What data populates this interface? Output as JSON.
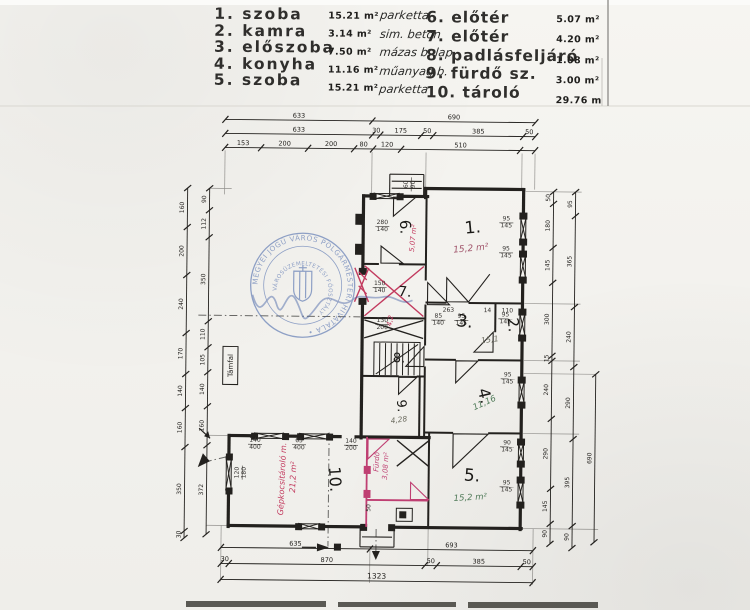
{
  "legend": {
    "left": [
      {
        "no": "1.",
        "name": "szoba",
        "area": "15.21 m²",
        "material": "parketta"
      },
      {
        "no": "2.",
        "name": "kamra",
        "area": "3.14 m²",
        "material": "sim. beton"
      },
      {
        "no": "3.",
        "name": "előszoba",
        "area": "7.50 m²",
        "material": "mázas b. lap"
      },
      {
        "no": "4.",
        "name": "konyha",
        "area": "11.16 m²",
        "material": "műanyag b."
      },
      {
        "no": "5.",
        "name": "szoba",
        "area": "15.21 m²",
        "material": "parketta"
      }
    ],
    "right": [
      {
        "no": "6.",
        "name": "előtér",
        "area": "5.07 m²",
        "material": "má—"
      },
      {
        "no": "7.",
        "name": "előtér",
        "area": "4.20 m²",
        "material": "má—"
      },
      {
        "no": "8.",
        "name": "padlásfeljáró",
        "area": "1.08 m²",
        "material": "fa—"
      },
      {
        "no": "9.",
        "name": "fürdő sz.",
        "area": "3.00 m²",
        "material": "má—"
      },
      {
        "no": "10.",
        "name": "tároló",
        "area": "29.76 m²",
        "material": "si—"
      }
    ]
  },
  "stamp": {
    "ring_text": "MEGYEI JOGÚ VÁROS POLGÁRMESTERI HIVATALA •",
    "inner_text": "VÁROSÜZEMELTETÉSI FŐOSZTÁLY",
    "cx": 302,
    "cy": 286,
    "r1": 52,
    "r2": 35
  },
  "colors": {
    "ink": "#23211e",
    "red": "#c23a5e",
    "magenta": "#bf3f72",
    "green": "#4f7a58",
    "pencil": "#6b6b5f",
    "blue": "#3d5ea6"
  },
  "plan": {
    "walls": [
      [
        362,
        196,
        372,
        196
      ],
      [
        398,
        196,
        426,
        196
      ],
      [
        424,
        188,
        522,
        188
      ],
      [
        424,
        188,
        424,
        197
      ],
      [
        522,
        188,
        522,
        215
      ],
      [
        522,
        240,
        522,
        252
      ],
      [
        522,
        277,
        522,
        310
      ],
      [
        522,
        335,
        522,
        378
      ],
      [
        522,
        403,
        522,
        440
      ],
      [
        522,
        462,
        522,
        478
      ],
      [
        522,
        503,
        522,
        528
      ],
      [
        362,
        196,
        362,
        272
      ],
      [
        362,
        302,
        362,
        438
      ],
      [
        230,
        437,
        255,
        437
      ],
      [
        285,
        437,
        300,
        437
      ],
      [
        330,
        437,
        341,
        437
      ],
      [
        357,
        437,
        430,
        437
      ],
      [
        230,
        437,
        230,
        458
      ],
      [
        230,
        492,
        230,
        528
      ],
      [
        230,
        527,
        300,
        527
      ],
      [
        322,
        527,
        365,
        527
      ],
      [
        392,
        527,
        523,
        527
      ]
    ],
    "inner": [
      [
        362,
        264,
        378,
        264
      ],
      [
        398,
        264,
        425,
        264
      ],
      [
        362,
        318,
        425,
        318
      ],
      [
        425,
        197,
        425,
        280
      ],
      [
        425,
        304,
        425,
        345
      ],
      [
        425,
        366,
        425,
        438
      ],
      [
        425,
        302,
        446,
        302
      ],
      [
        468,
        302,
        522,
        302
      ],
      [
        495,
        302,
        495,
        331
      ],
      [
        425,
        359,
        456,
        359
      ],
      [
        478,
        359,
        522,
        359
      ],
      [
        362,
        376,
        399,
        376
      ],
      [
        417,
        376,
        425,
        376
      ],
      [
        420,
        376,
        420,
        437
      ],
      [
        425,
        432,
        454,
        432
      ],
      [
        489,
        432,
        522,
        432
      ],
      [
        430,
        432,
        430,
        527
      ]
    ],
    "thin": [
      [
        388,
        174,
        422,
        174
      ],
      [
        388,
        174,
        388,
        196
      ],
      [
        422,
        174,
        422,
        196
      ],
      [
        390,
        181,
        420,
        181
      ],
      [
        390,
        188,
        420,
        188
      ],
      [
        362,
        527,
        362,
        547
      ],
      [
        396,
        527,
        396,
        547
      ],
      [
        362,
        547,
        396,
        547
      ],
      [
        364,
        537,
        394,
        537
      ],
      [
        468,
        301,
        489,
        273
      ]
    ],
    "guides": [
      [
        223,
        152,
        223,
        196
      ],
      [
        370,
        152,
        370,
        196
      ],
      [
        424,
        152,
        424,
        188
      ],
      [
        520,
        152,
        520,
        188
      ],
      [
        533,
        152,
        533,
        188
      ],
      [
        223,
        527,
        223,
        583
      ],
      [
        372,
        547,
        372,
        583
      ],
      [
        430,
        527,
        430,
        565
      ],
      [
        535,
        527,
        535,
        583
      ],
      [
        208,
        190,
        230,
        190
      ],
      [
        208,
        437,
        230,
        437
      ],
      [
        208,
        527,
        230,
        527
      ],
      [
        524,
        190,
        580,
        190
      ],
      [
        524,
        302,
        580,
        302
      ],
      [
        524,
        359,
        580,
        359
      ],
      [
        524,
        432,
        580,
        432
      ],
      [
        524,
        527,
        600,
        527
      ],
      [
        524,
        372,
        596,
        372
      ]
    ],
    "piers": [
      [
        518,
        211,
        8,
        7
      ],
      [
        518,
        237,
        8,
        7
      ],
      [
        518,
        249,
        8,
        7
      ],
      [
        518,
        275,
        8,
        7
      ],
      [
        518,
        307,
        8,
        7
      ],
      [
        518,
        333,
        8,
        7
      ],
      [
        518,
        375,
        8,
        7
      ],
      [
        518,
        400,
        8,
        7
      ],
      [
        518,
        437,
        8,
        7
      ],
      [
        518,
        459,
        8,
        7
      ],
      [
        518,
        475,
        8,
        7
      ],
      [
        518,
        500,
        8,
        7
      ],
      [
        368,
        193,
        7,
        7
      ],
      [
        395,
        193,
        7,
        7
      ],
      [
        252,
        434,
        7,
        7
      ],
      [
        283,
        434,
        7,
        7
      ],
      [
        298,
        434,
        7,
        7
      ],
      [
        327,
        434,
        7,
        7
      ],
      [
        227,
        455,
        7,
        7
      ],
      [
        227,
        489,
        7,
        7
      ],
      [
        297,
        524,
        7,
        7
      ],
      [
        320,
        524,
        7,
        7
      ],
      [
        362,
        524,
        7,
        7
      ],
      [
        390,
        524,
        7,
        7
      ],
      [
        358,
        268,
        8,
        7
      ],
      [
        358,
        298,
        8,
        7
      ],
      [
        354,
        214,
        7,
        11
      ],
      [
        354,
        244,
        7,
        11
      ]
    ],
    "vwins": [
      [
        522,
        215,
        240
      ],
      [
        522,
        252,
        277
      ],
      [
        522,
        310,
        335
      ],
      [
        522,
        378,
        403
      ],
      [
        522,
        440,
        462
      ],
      [
        522,
        478,
        503
      ],
      [
        230,
        458,
        492
      ]
    ],
    "hwins": [
      [
        196,
        372,
        398
      ],
      [
        437,
        255,
        285
      ],
      [
        437,
        300,
        330
      ],
      [
        527,
        300,
        322
      ]
    ],
    "doors": [
      {
        "p": "392,197 414,197 392,216",
        "c": "ink"
      },
      {
        "p": "380,263 402,263 380,246",
        "c": "ink"
      },
      {
        "p": "427,282 427,304 449,304",
        "c": "ink"
      },
      {
        "p": "446,301 468,301 446,277",
        "c": "ink"
      },
      {
        "p": "493,331 493,351 474,351",
        "c": "ink"
      },
      {
        "p": "456,360 478,360 456,382",
        "c": "ink"
      },
      {
        "p": "424,346 424,366 406,366",
        "c": "ink"
      },
      {
        "p": "399,377 417,377 399,394",
        "c": "ink"
      },
      {
        "p": "454,433 489,433 454,467",
        "c": "ink"
      },
      {
        "p": "369,439 390,439 369,459",
        "c": "magenta"
      },
      {
        "p": "412,499 430,499 412,482",
        "c": "magenta"
      }
    ],
    "xmarks": [
      {
        "x1": 364,
        "y1": 320,
        "x2": 423,
        "y2": 338,
        "c": "ink"
      },
      {
        "x1": 398,
        "y1": 440,
        "x2": 430,
        "y2": 466,
        "c": "ink"
      },
      {
        "x1": 364,
        "y1": 266,
        "x2": 423,
        "y2": 316,
        "c": "red"
      },
      {
        "x1": 354,
        "y1": 268,
        "x2": 368,
        "y2": 302,
        "c": "red"
      }
    ],
    "redlines": [
      [
        358,
        272,
        366,
        280
      ],
      [
        358,
        286,
        366,
        294
      ]
    ],
    "magwalls": [
      [
        368,
        437,
        368,
        527
      ],
      [
        368,
        500,
        430,
        500
      ]
    ],
    "magpiers": [
      [
        365,
        466,
        7,
        8
      ],
      [
        365,
        490,
        7,
        8
      ]
    ],
    "stairs": {
      "x": 374,
      "y": 342,
      "w": 46,
      "h": 34
    },
    "dashes": [
      [
        330,
        433,
        330,
        547
      ],
      [
        378,
        529,
        378,
        554
      ],
      [
        198,
        317,
        360,
        317
      ],
      [
        205,
        464,
        233,
        457
      ]
    ],
    "arrowlines": [
      [
        304,
        548,
        318,
        548
      ],
      [
        200,
        430,
        211,
        440
      ]
    ],
    "arrowpolys": [
      "319,544 319,552 331,548",
      "374,551 382,551 378,560",
      "199,469 211,463 204,455",
      "211,440 205,438 209,433"
    ],
    "flue": {
      "x": 398,
      "y": 508,
      "w": 16,
      "h": 13
    },
    "bsquare": [
      336,
      544,
      7,
      7
    ],
    "tamfal": {
      "label": "Támfal",
      "x": 223,
      "y": 348,
      "w": 15,
      "h": 38
    },
    "chains": [
      {
        "o": "h",
        "x": 223,
        "y": 121,
        "segs": [
          [
            "633",
            147
          ],
          [
            "690",
            163
          ]
        ]
      },
      {
        "o": "h",
        "x": 223,
        "y": 135,
        "segs": [
          [
            "633",
            147
          ],
          [
            "30",
            8
          ],
          [
            "175",
            41
          ],
          [
            "50",
            12
          ],
          [
            "385",
            90
          ],
          [
            "50",
            12
          ]
        ]
      },
      {
        "o": "h",
        "x": 223,
        "y": 149,
        "segs": [
          [
            "153",
            36
          ],
          [
            "200",
            47
          ],
          [
            "200",
            46
          ],
          [
            "80",
            19
          ],
          [
            "120",
            28
          ],
          [
            "510",
            119
          ],
          [
            "",
            15
          ]
        ]
      },
      {
        "o": "h",
        "x": 223,
        "y": 549,
        "segs": [
          [
            "635",
            149
          ],
          [
            "693",
            163
          ]
        ]
      },
      {
        "o": "h",
        "x": 223,
        "y": 565,
        "segs": [
          [
            "30",
            8
          ],
          [
            "870",
            196
          ],
          [
            "50",
            12
          ],
          [
            "385",
            84
          ],
          [
            "50",
            12
          ]
        ]
      },
      {
        "o": "h",
        "x": 223,
        "y": 581,
        "segs": [
          [
            "1323",
            312
          ]
        ]
      },
      {
        "o": "v",
        "x": 186,
        "y": 190,
        "segs": [
          [
            "160",
            39
          ],
          [
            "200",
            48
          ],
          [
            "240",
            58
          ],
          [
            "170",
            41
          ],
          [
            "140",
            34
          ],
          [
            "160",
            39
          ],
          [
            "350",
            84
          ],
          [
            "30",
            7
          ]
        ]
      },
      {
        "o": "v",
        "x": 208,
        "y": 190,
        "segs": [
          [
            "90",
            22
          ],
          [
            "112",
            27
          ],
          [
            "350",
            84
          ],
          [
            "110",
            26
          ],
          [
            "105",
            25
          ],
          [
            "140",
            34
          ],
          [
            "160",
            39
          ],
          [
            "372",
            89
          ]
        ]
      },
      {
        "o": "v",
        "x": 552,
        "y": 190,
        "segs": [
          [
            "50",
            12
          ],
          [
            "180",
            44
          ],
          [
            "145",
            35
          ],
          [
            "300",
            73
          ],
          [
            "15",
            5
          ],
          [
            "240",
            58
          ],
          [
            "290",
            70
          ],
          [
            "145",
            35
          ],
          [
            "90",
            20
          ]
        ]
      },
      {
        "o": "v",
        "x": 574,
        "y": 190,
        "segs": [
          [
            "95",
            24
          ],
          [
            "365",
            91
          ],
          [
            "240",
            60
          ],
          [
            "290",
            72
          ],
          [
            "395",
            87
          ],
          [
            "90",
            22
          ]
        ]
      },
      {
        "o": "v",
        "x": 596,
        "y": 372,
        "segs": [
          [
            "690",
            168
          ]
        ]
      }
    ],
    "dimpairs": [
      [
        381,
        224,
        "280",
        "140",
        0
      ],
      [
        448,
        311,
        "263",
        "",
        0
      ],
      [
        487,
        311,
        "14",
        "",
        0
      ],
      [
        507,
        311,
        "110",
        "",
        0
      ],
      [
        505,
        219,
        "95",
        "145",
        0
      ],
      [
        505,
        249,
        "95",
        "145",
        0
      ],
      [
        505,
        315,
        "95",
        "145",
        0
      ],
      [
        508,
        375,
        "95",
        "145",
        0
      ],
      [
        508,
        443,
        "90",
        "145",
        0
      ],
      [
        508,
        483,
        "95",
        "145",
        0
      ],
      [
        379,
        285,
        "150",
        "140",
        0
      ],
      [
        382,
        322,
        "130",
        "200",
        0
      ],
      [
        438,
        317,
        "85",
        "140",
        0
      ],
      [
        461,
        317,
        "95",
        "145",
        0
      ],
      [
        256,
        443,
        "140",
        "400",
        0
      ],
      [
        300,
        443,
        "65",
        "400",
        0
      ],
      [
        352,
        443,
        "140",
        "200",
        0
      ],
      [
        240,
        474,
        "120",
        "180",
        -90
      ],
      [
        406,
        184,
        "60",
        "90",
        -90
      ],
      [
        372,
        508,
        "50",
        "",
        -90
      ]
    ],
    "roomlabels": [
      [
        "1.",
        472,
        232,
        -6,
        17
      ],
      [
        "2.",
        508,
        324,
        84,
        15
      ],
      [
        "3.",
        464,
        326,
        6,
        17
      ],
      [
        "4.",
        480,
        396,
        76,
        16
      ],
      [
        "5.",
        473,
        480,
        4,
        17
      ],
      [
        "6.",
        399,
        227,
        86,
        15
      ],
      [
        "7.",
        404,
        296,
        4,
        14
      ],
      [
        "8.",
        399,
        362,
        2,
        13
      ],
      [
        "9.",
        398,
        406,
        84,
        13
      ],
      [
        "10.",
        331,
        480,
        86,
        16
      ]
    ],
    "notes": [
      [
        "15,2 m²",
        470,
        250,
        -6,
        9,
        "#a0546a"
      ],
      [
        "15,1",
        490,
        341,
        -8,
        8,
        "#6b6b5f"
      ],
      [
        "11,16",
        486,
        404,
        -25,
        8.5,
        "#4f7a58"
      ],
      [
        "15,2 m²",
        472,
        499,
        -4,
        8.5,
        "#4f7a58"
      ],
      [
        "4,28",
        400,
        422,
        -8,
        7.5,
        "#6b6b5f"
      ],
      [
        "4,2",
        392,
        321,
        -80,
        7,
        "#c23a5e"
      ],
      [
        "5,07 m²",
        414,
        238,
        -85,
        7,
        "#c23a5e"
      ],
      [
        "Gépkocsitároló m.",
        286,
        480,
        -88,
        8,
        "#c23a5e"
      ],
      [
        "21,2 m²",
        297,
        478,
        -88,
        8,
        "#c23a5e"
      ],
      [
        "Fürdő",
        380,
        462,
        -87,
        7,
        "#bf3f72"
      ],
      [
        "3,08 m²",
        389,
        466,
        -87,
        7,
        "#bf3f72"
      ]
    ]
  }
}
